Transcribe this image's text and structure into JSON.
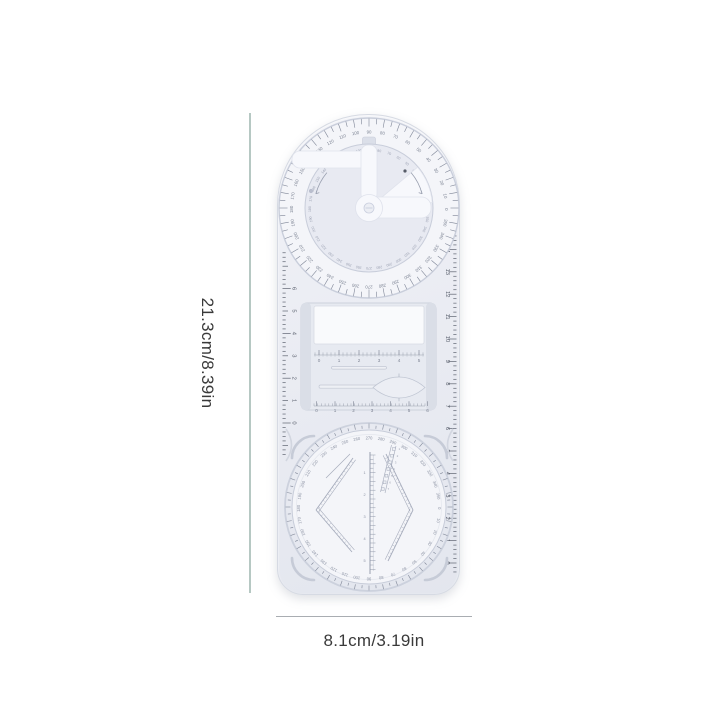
{
  "page": {
    "background": "#ffffff"
  },
  "annotations": {
    "height_label": "21.3cm/8.39in",
    "width_label": "8.1cm/3.19in"
  },
  "product": {
    "description": "transparent multifunctional geometric drawing ruler template",
    "colors": {
      "body": "#eceef4",
      "body_edge": "#d6dae3",
      "ring_fill": "#f4f5f9",
      "ring_stroke": "#c9cedb",
      "disc_fill": "#e8eaf2",
      "white_part": "#f7f8fc",
      "tick": "#7f8697",
      "edge_tick": "#5d6370",
      "degree_number": "#7d8494",
      "faint_number": "#9ba1b2",
      "template_stroke": "#a6acbc",
      "bracket": "#c6cbd7",
      "dim_line_v": "#b6c8c3",
      "dim_line_h": "#a9adb2",
      "dim_text": "#3a3a3a"
    },
    "top_protractor": {
      "outer_degree_labels": [
        0,
        10,
        20,
        30,
        40,
        50,
        60,
        70,
        80,
        90,
        100,
        110,
        120,
        130,
        140,
        150,
        160,
        170,
        180,
        190,
        200,
        210,
        220,
        230,
        240,
        250,
        260,
        270,
        280,
        290,
        300,
        310,
        320,
        330,
        340,
        350
      ],
      "inner_degree_labels": [
        0,
        10,
        20,
        30,
        40,
        50,
        60,
        70,
        80,
        90,
        100,
        110,
        120,
        130,
        140,
        150,
        160,
        170,
        180,
        190,
        200,
        210,
        220,
        230,
        240,
        250,
        260,
        270,
        280,
        290,
        300,
        310,
        320,
        330,
        340,
        350
      ]
    },
    "left_ruler": {
      "labels": [
        0,
        1,
        2,
        3,
        4,
        5,
        6
      ]
    },
    "right_ruler": {
      "labels": [
        0,
        1,
        2,
        3,
        4,
        5,
        6,
        7,
        8,
        9,
        10,
        11,
        12,
        13,
        14,
        15
      ]
    },
    "middle_template": {
      "top_scale_labels": [
        0,
        1,
        2,
        3,
        4,
        5
      ],
      "bottom_scale_labels": [
        0,
        1,
        2,
        3,
        4,
        5,
        6
      ]
    },
    "bottom_disc": {
      "degree_labels": [
        0,
        10,
        20,
        30,
        40,
        50,
        60,
        70,
        80,
        90,
        100,
        110,
        120,
        130,
        140,
        150,
        160,
        170,
        180,
        190,
        200,
        210,
        220,
        230,
        240,
        250,
        260,
        270,
        280,
        290,
        300,
        310,
        320,
        330,
        340,
        350
      ],
      "center_ruler_labels": [
        1,
        2,
        3,
        4,
        5
      ],
      "circle_template_labels": [
        1,
        2,
        3,
        4,
        5,
        6,
        7
      ]
    }
  }
}
